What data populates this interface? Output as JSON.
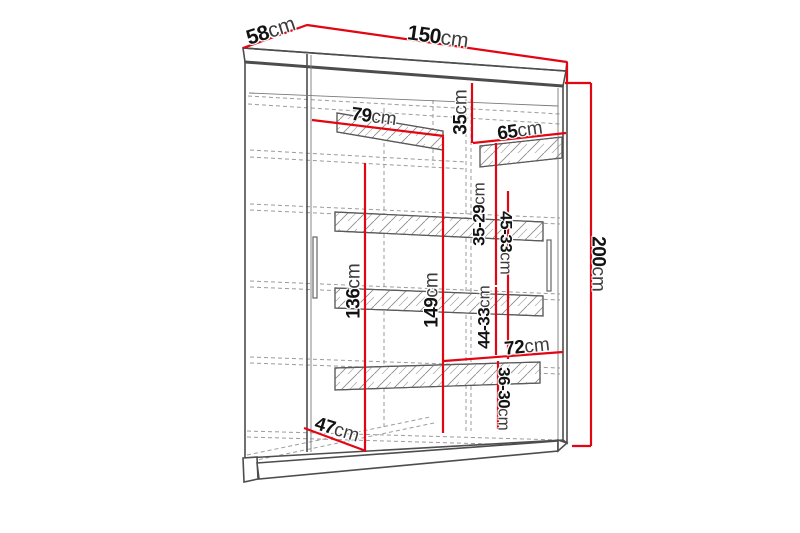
{
  "diagram": {
    "title": "wardrobe-dimension-drawing",
    "unit": "cm",
    "labels": {
      "depth_top": {
        "value": "58",
        "unit": "cm"
      },
      "width_top": {
        "value": "150",
        "unit": "cm"
      },
      "inner_left_width": {
        "value": "79",
        "unit": "cm"
      },
      "top_shelf_gap": {
        "value": "35",
        "unit": "cm"
      },
      "inner_right_width": {
        "value": "65",
        "unit": "cm"
      },
      "shelf_gap_1": {
        "value": "35-29",
        "unit": "cm"
      },
      "shelf_gap_2": {
        "value": "45-33",
        "unit": "cm"
      },
      "left_interior_height": {
        "value": "136",
        "unit": "cm"
      },
      "right_interior_height": {
        "value": "149",
        "unit": "cm"
      },
      "shelf_gap_3": {
        "value": "44-33",
        "unit": "cm"
      },
      "bottom_shelf_width": {
        "value": "72",
        "unit": "cm"
      },
      "shelf_gap_4": {
        "value": "36-30",
        "unit": "cm"
      },
      "interior_depth": {
        "value": "47",
        "unit": "cm"
      },
      "total_height": {
        "value": "200",
        "unit": "cm"
      }
    },
    "colors": {
      "dimension_line": "#e20613",
      "outline": "#4d4d4d",
      "hidden_line": "#9b9b9b",
      "label_number": "#121212",
      "label_unit": "#3d3d3d",
      "background": "#ffffff"
    }
  }
}
